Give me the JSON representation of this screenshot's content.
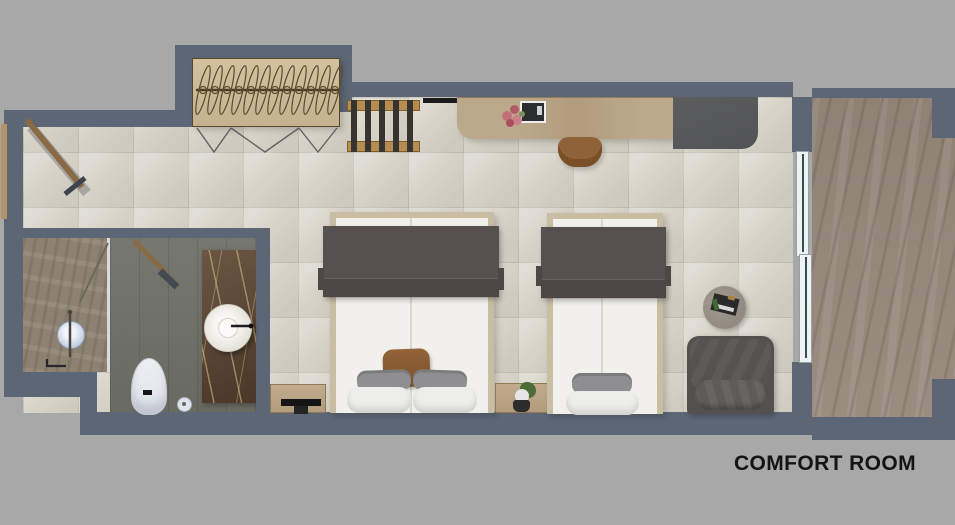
{
  "title": {
    "label": "COMFORT ROOM"
  },
  "palette": {
    "background": "#a8a8a8",
    "wall": "#5d6675",
    "floor_tile": "#d7d3c8",
    "balcony_floor": "#97887b",
    "bathroom_floor": "#6f7067",
    "shower_floor": "#8d8172",
    "marble_counter": "#5d4936",
    "wood_desk": "#b7a383",
    "wardrobe": "#cdbb97",
    "bed_blanket": "#565150",
    "mattress": "#f1f0ec",
    "armchair": "#5a5856",
    "accent_pillow": "#8a5c34",
    "porcelain": "#e9ebf0",
    "door_wood": "#8a6a45",
    "glass": "#e8ecec"
  }
}
